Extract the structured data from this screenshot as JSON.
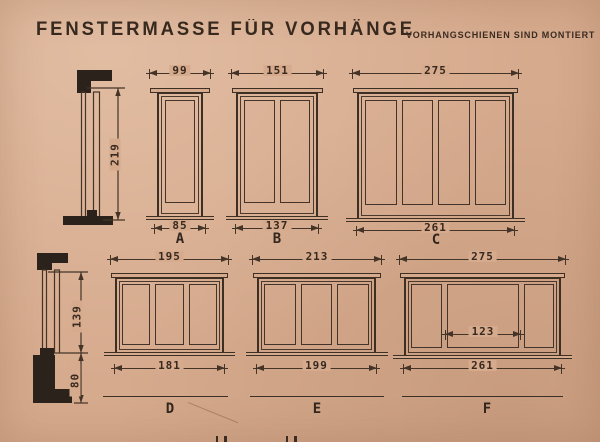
{
  "page": {
    "title": "FENSTERMASSE FÜR VORHÄNGE",
    "subtitle": "VORHANGSCHIENEN SIND MONTIERT"
  },
  "windows": [
    {
      "label": "A",
      "top_width": "99",
      "bottom_width": "85",
      "panes": 1
    },
    {
      "label": "B",
      "top_width": "151",
      "bottom_width": "137",
      "panes": 2
    },
    {
      "label": "C",
      "top_width": "275",
      "bottom_width": "261",
      "panes": 4
    },
    {
      "label": "D",
      "top_width": "195",
      "bottom_width": "181",
      "panes": 3
    },
    {
      "label": "E",
      "top_width": "213",
      "bottom_width": "199",
      "panes": 3
    },
    {
      "label": "F",
      "top_width": "275",
      "bottom_width": "261",
      "panes": 3,
      "middle_width": "123"
    }
  ],
  "profiles": {
    "top": {
      "height": "219"
    },
    "bottom": {
      "upper": "139",
      "lower": "80"
    }
  },
  "colors": {
    "paper": "#d6aa8d",
    "ink": "#3e2f24",
    "fill_black": "#2b221b"
  }
}
